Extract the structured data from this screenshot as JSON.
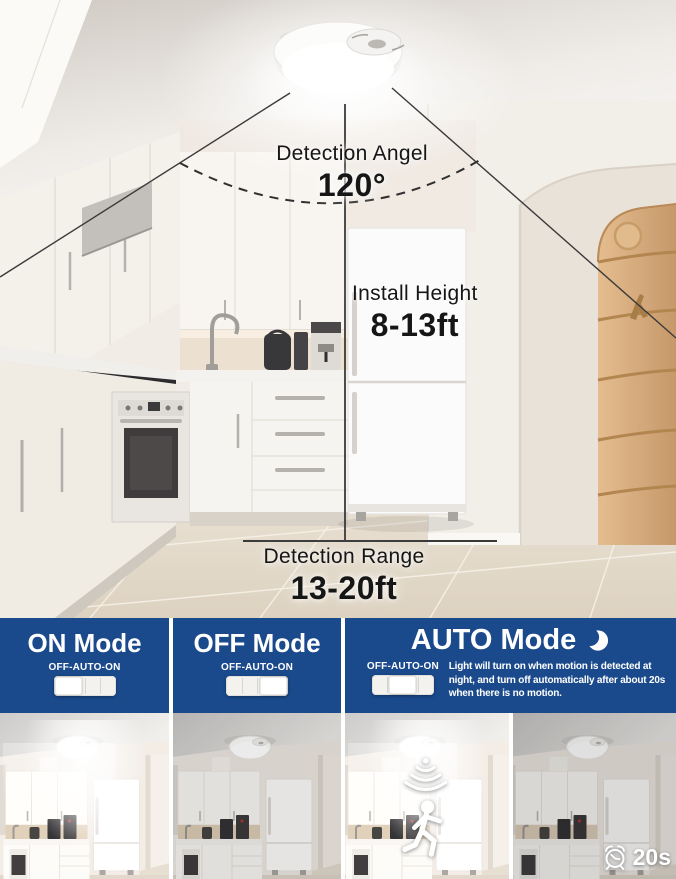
{
  "colors": {
    "panel_blue": "#1a4a8c",
    "annotation_text": "#161616",
    "mode_text": "#ffffff"
  },
  "diagram": {
    "detection_angle": {
      "label": "Detection Angel",
      "value": "120°"
    },
    "install_height": {
      "label": "Install Height",
      "value": "8-13ft"
    },
    "detection_range": {
      "label": "Detection Range",
      "value": "13-20ft"
    }
  },
  "modes": {
    "on": {
      "title": "ON Mode",
      "switch_label": "OFF-AUTO-ON",
      "switch_position": "left"
    },
    "off": {
      "title": "OFF Mode",
      "switch_label": "OFF-AUTO-ON",
      "switch_position": "right"
    },
    "auto": {
      "title": "AUTO Mode",
      "switch_label": "OFF-AUTO-ON",
      "switch_position": "middle",
      "description_lines": [
        "Light will turn on when motion is detected at",
        "night, and turn off automatically after about 20s",
        "when there is no motion."
      ],
      "timer_value": "20s"
    }
  }
}
